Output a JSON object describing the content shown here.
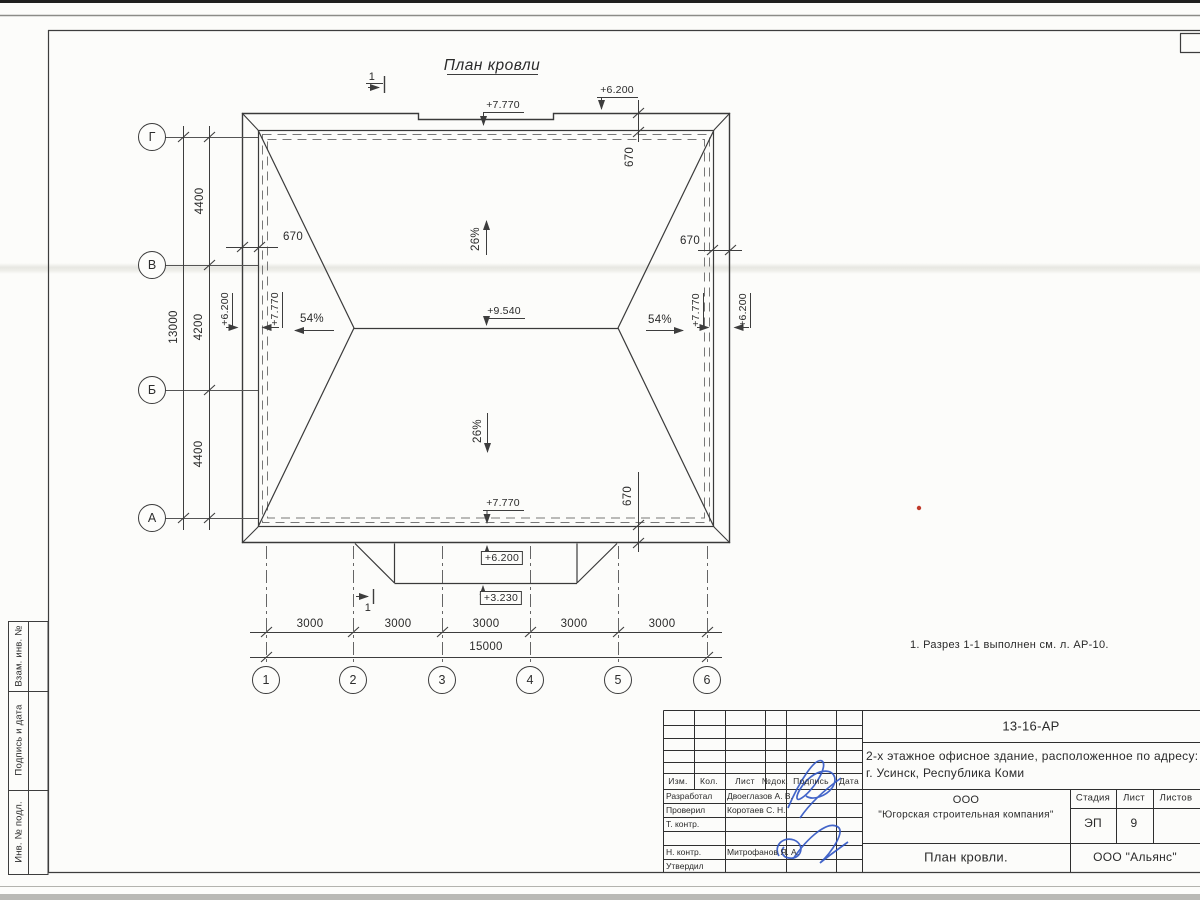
{
  "sheet": {
    "title": "План кровли",
    "note": "1. Разрез 1-1 выполнен см. л. АР-10.",
    "section_label": "1"
  },
  "axes": {
    "rows": [
      "Г",
      "В",
      "Б",
      "А"
    ],
    "cols": [
      "1",
      "2",
      "3",
      "4",
      "5",
      "6"
    ]
  },
  "dims": {
    "vertical": [
      "4400",
      "4200",
      "4400"
    ],
    "vertical_total": "13000",
    "horizontal": [
      "3000",
      "3000",
      "3000",
      "3000",
      "3000"
    ],
    "horizontal_total": "15000",
    "overhang": "670"
  },
  "marks": {
    "ridge": "+9.540",
    "parapet": "+7.770",
    "eave": "+6.200",
    "canopy": "+3.230",
    "slope_main": "26%",
    "slope_side": "54%"
  },
  "titleblock": {
    "doc_number": "13-16-АР",
    "project_line1": "2-х этажное офисное здание, расположенное по адресу:",
    "project_line2": "г. Усинск, Республика Коми",
    "columns": [
      "Изм.",
      "Кол.",
      "Лист",
      "№док.",
      "Подпись",
      "Дата"
    ],
    "rows": [
      {
        "label": "Разработал",
        "name": "Двоеглазов А. В."
      },
      {
        "label": "Проверил",
        "name": "Коротаев С. Н."
      },
      {
        "label": "Т. контр.",
        "name": ""
      },
      {
        "label": "Н. контр.",
        "name": "Митрофанов Я. А."
      },
      {
        "label": "Утвердил",
        "name": ""
      }
    ],
    "company_line1": "ООО",
    "company_line2": "\"Югорская строительная компания\"",
    "stage_label": "Стадия",
    "sheet_label": "Лист",
    "sheets_label": "Листов",
    "stage_value": "ЭП",
    "sheet_value": "9",
    "sheets_value": "",
    "drawing_title": "План кровли.",
    "approver_org": "ООО \"Альянс\""
  },
  "side_column": {
    "labels": [
      "Взам. инв. №",
      "Подпись и дата",
      "Инв. № подл."
    ]
  },
  "colors": {
    "ink": "#3d3d3d",
    "signature": "#2f55c4",
    "paper": "#fcfcfa"
  }
}
